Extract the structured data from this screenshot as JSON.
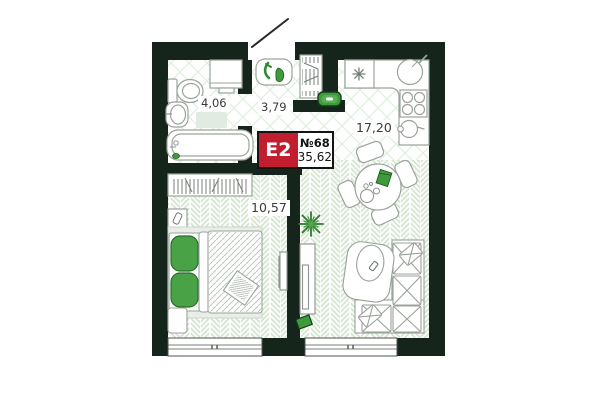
{
  "floor_plan": {
    "badge": {
      "layout_code": "E2",
      "unit_number": "№68",
      "total_area": "35,62"
    },
    "rooms": [
      {
        "id": "bathroom",
        "area": "4,06"
      },
      {
        "id": "hallway",
        "area": "3,79"
      },
      {
        "id": "kitchen_living",
        "area": "17,20"
      },
      {
        "id": "bedroom",
        "area": "10,57"
      }
    ],
    "colors": {
      "wall": "#16251b",
      "badge_red": "#c11f2f",
      "furniture_green": "#3e9b3b",
      "plant_green": "#2d7a30",
      "floor_plank": "#d6e7d1",
      "tile_line": "#e0efdf"
    }
  }
}
